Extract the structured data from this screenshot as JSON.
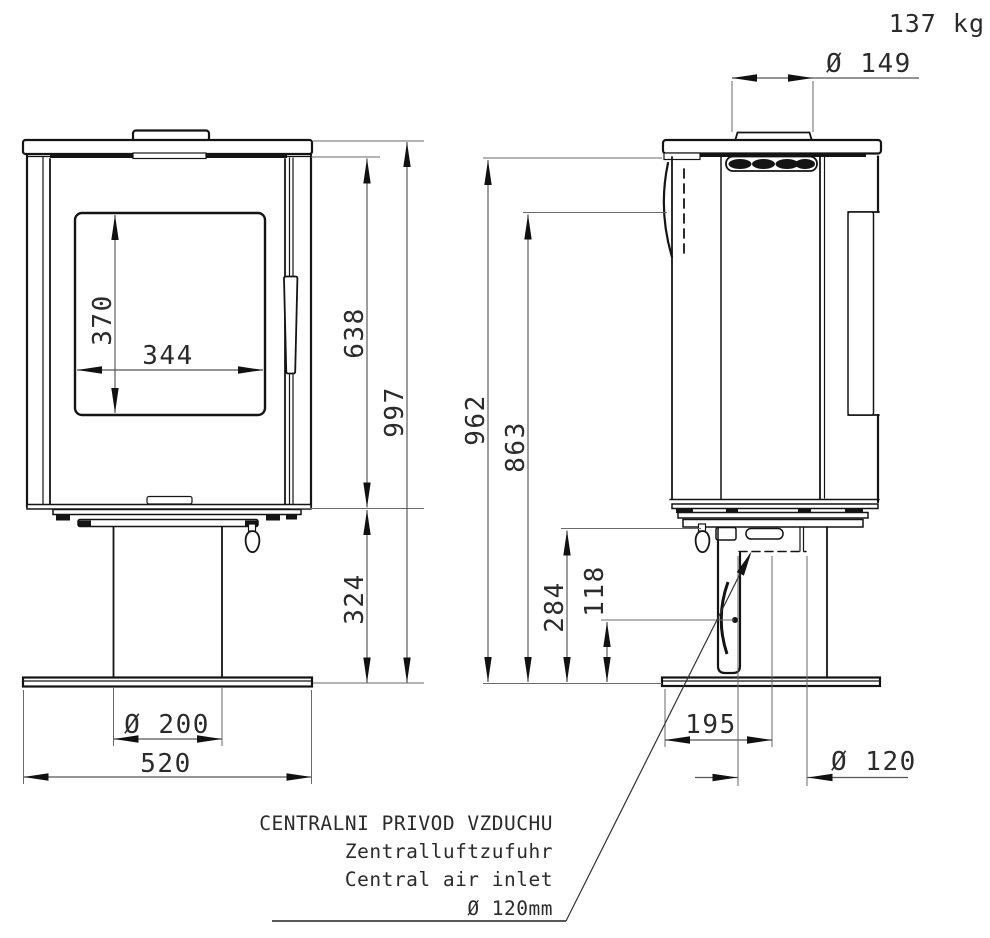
{
  "weight_label": "137 kg",
  "front_view": {
    "dimensions": {
      "glass_height": "370",
      "glass_width": "344",
      "firebox_height": "638",
      "total_height": "997",
      "pedestal_height": "324",
      "column_diameter": "Ø 200",
      "base_width": "520"
    }
  },
  "side_view": {
    "dimensions": {
      "flue_collar_diameter": "Ø 149",
      "height_to_top": "962",
      "height_to_outlet": "863",
      "inlet_pipe_top": "284",
      "inlet_pipe_center": "118",
      "inlet_offset": "195",
      "inlet_diameter": "Ø 120"
    }
  },
  "air_inlet_note": {
    "line_czech": "CENTRALNI PRIVOD VZDUCHU",
    "line_german": "Zentralluftzufuhr",
    "line_english": "Central air inlet",
    "line_diameter": "Ø 120mm"
  }
}
